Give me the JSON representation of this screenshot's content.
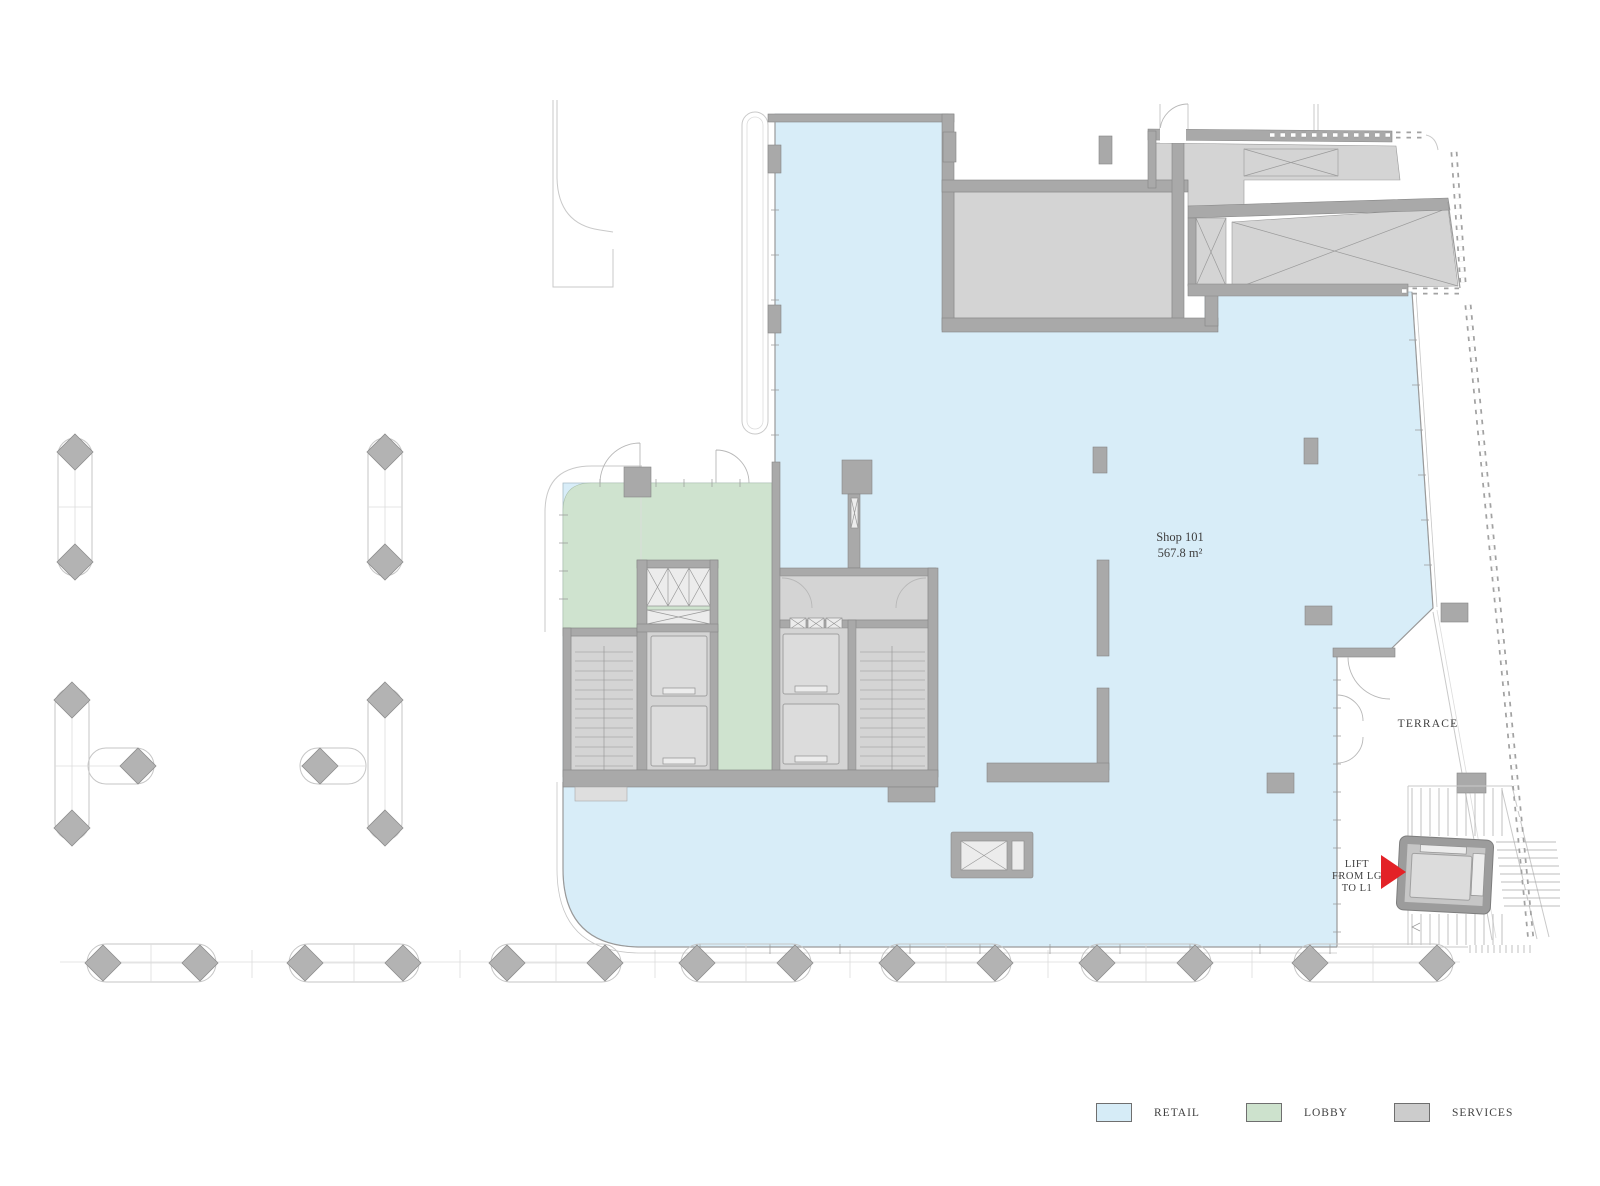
{
  "labels": {
    "shop_name": "Shop 101",
    "shop_area": "567.8 m²",
    "terrace": "TERRACE",
    "lift_line1": "LIFT",
    "lift_line2": "FROM LG",
    "lift_line3": "TO L1"
  },
  "legend": {
    "items": [
      {
        "label": "RETAIL",
        "color": "#d6ecf7"
      },
      {
        "label": "LOBBY",
        "color": "#cde2cd"
      },
      {
        "label": "SERVICES",
        "color": "#cccccc"
      }
    ]
  },
  "colors": {
    "retail": "#d8edf8",
    "lobby": "#cfe3cf",
    "services": "#d4d4d4",
    "wall": "#a9a9a9",
    "arrow_red": "#e32227"
  }
}
